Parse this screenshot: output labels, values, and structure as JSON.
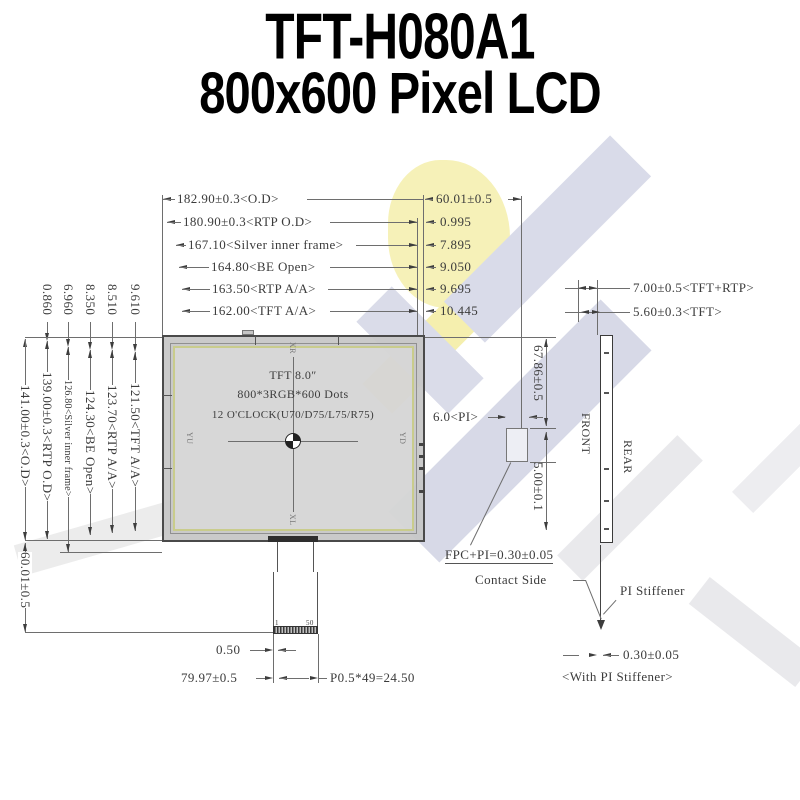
{
  "title": {
    "line1": "TFT-H080A1",
    "line2": "800x600 Pixel LCD"
  },
  "top_dims": [
    {
      "label": "182.90±0.3<O.D>",
      "right": "60.01±0.5"
    },
    {
      "label": "180.90±0.3<RTP O.D>",
      "right": "0.995"
    },
    {
      "label": "167.10<Silver inner frame>",
      "right": "7.895"
    },
    {
      "label": "164.80<BE Open>",
      "right": "9.050"
    },
    {
      "label": "163.50<RTP A/A>",
      "right": "9.695"
    },
    {
      "label": "162.00<TFT A/A>",
      "right": "10.445"
    }
  ],
  "left_dims": [
    {
      "offset": "",
      "label": "141.00±0.3<O.D>"
    },
    {
      "offset": "0.860",
      "label": "139.00±0.3<RTP O.D>"
    },
    {
      "offset": "6.960",
      "label": "126.80<Silver inner frame>"
    },
    {
      "offset": "8.350",
      "label": "124.30<BE Open>"
    },
    {
      "offset": "8.510",
      "label": "123.70<RTP A/A>"
    },
    {
      "offset": "9.610",
      "label": "121.50<TFT A/A>"
    }
  ],
  "left_fpc_length": "60.01±0.5",
  "panel": {
    "line1": "TFT 8.0″",
    "line2": "800*3RGB*600 Dots",
    "line3": "12 O'CLOCK(U70/D75/L75/R75)",
    "dir_top": "XR",
    "dir_bottom": "XL",
    "dir_left": "YU",
    "dir_right": "YD"
  },
  "side": {
    "dim_total": "7.00±0.5<TFT+RTP>",
    "dim_tft": "5.60±0.3<TFT>",
    "height": "67.86±0.5",
    "pi": "6.0<PI>",
    "pi_gap": "5.00±0.1",
    "front": "FRONT",
    "rear": "REAR"
  },
  "notes": {
    "fpc_pi": "FPC+PI=0.30±0.05",
    "contact": "Contact Side",
    "stiffener": "PI Stiffener",
    "thickness": "0.30±0.05",
    "with_stiffener": "<With PI Stiffener>"
  },
  "fpc": {
    "pin1": "1",
    "pin50": "50",
    "d050": "0.50",
    "d7997": "79.97±0.5",
    "pitch": "P0.5*49=24.50"
  },
  "colors": {
    "line": "#6e6e6e",
    "text": "#3b3b3b",
    "bezel": "#c6c6c6",
    "active_frame": "#c9cc8c",
    "watermark_blue": "#d9dbe9",
    "watermark_yellow": "#f6f1b8",
    "watermark_gray": "#e9e9ec"
  }
}
